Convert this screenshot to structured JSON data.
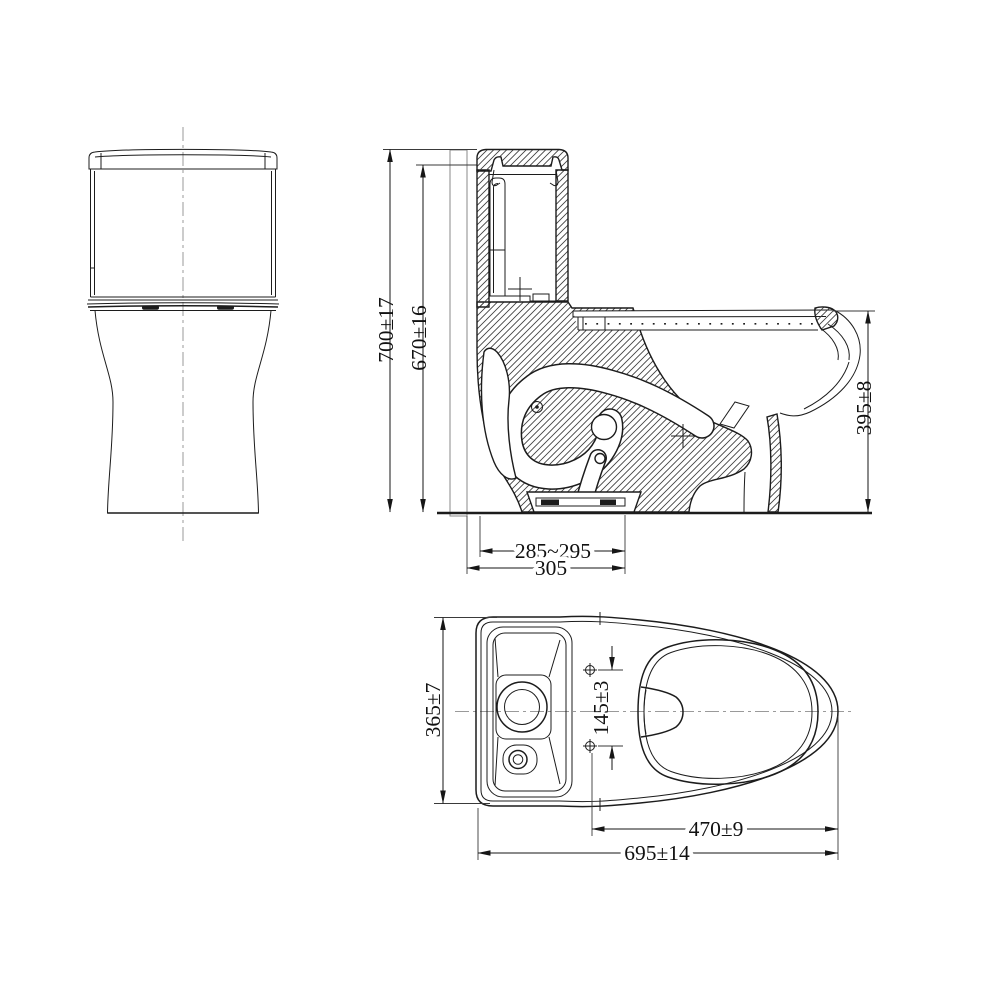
{
  "drawing": {
    "colors": {
      "background": "#ffffff",
      "line": "#1c1c1c",
      "wall_hatch": "#8a8a8a",
      "centerline": "#9a9a9a"
    },
    "dimensions": {
      "overall_height": "700±17",
      "tank_top_height": "670±16",
      "bowl_rim_height": "395±8",
      "rough_in_range": "285~295",
      "rough_in_max": "305",
      "overall_width": "365±7",
      "bolt_hole_spacing": "145±3",
      "bowl_length": "470±9",
      "overall_length": "695±14"
    }
  }
}
